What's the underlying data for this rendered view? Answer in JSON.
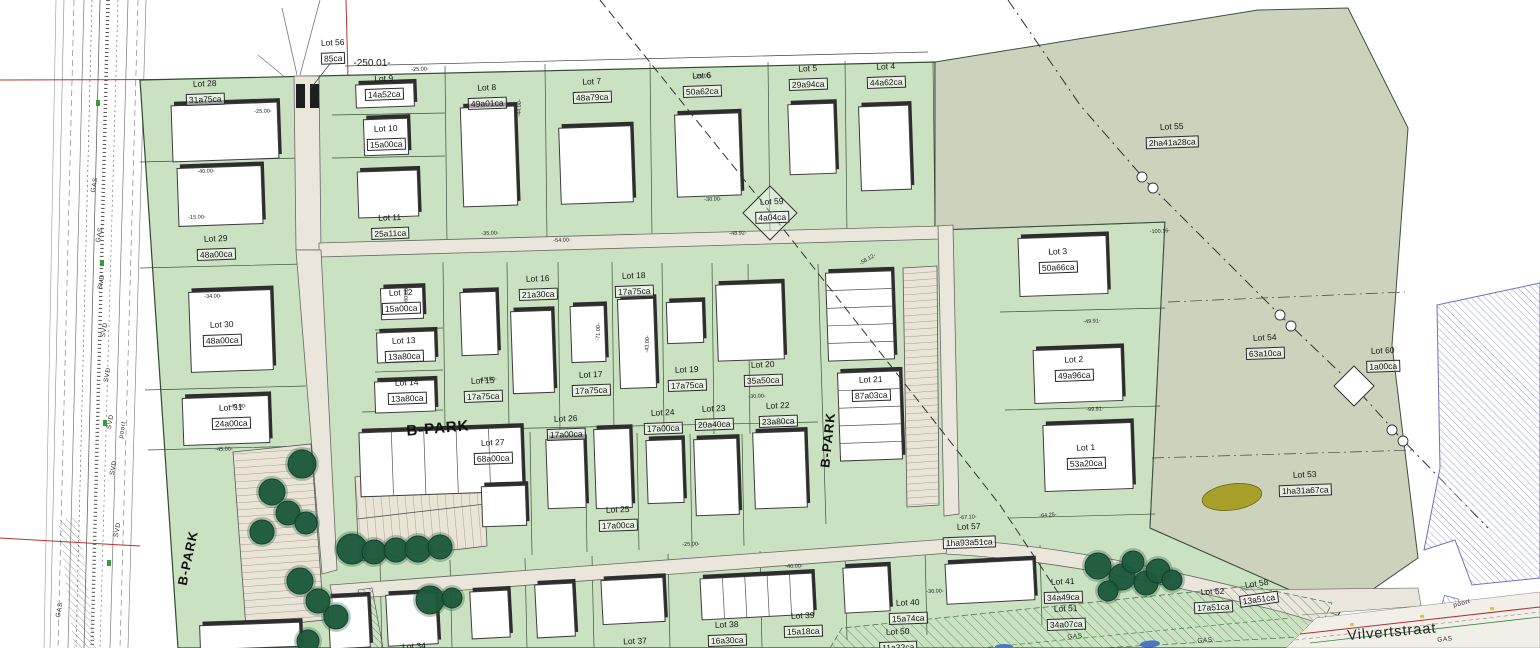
{
  "drawing": {
    "street_name": "Vilvertstraat",
    "park_label": "B-PARK",
    "overall_dimension": "-250.01-",
    "colors": {
      "parcel_green": "#cbe2c2",
      "reserve_olive": "#cdd2bd",
      "road_beige": "#eae6db",
      "building_fill": "#ffffff",
      "building_shadow": "#2d2d2d",
      "tree_green": "#1d5a3c",
      "existing_building_hatch_blue": "#9a9ad2",
      "pond_olive": "#a7a02b",
      "marker_red": "#c03030"
    }
  },
  "lots": [
    {
      "name": "Lot 28",
      "area": "31a75ca",
      "x": 205,
      "y": 93,
      "r": -2
    },
    {
      "name": "Lot 56",
      "area": "85ca",
      "x": 333,
      "y": 52,
      "r": -2
    },
    {
      "name": "Lot 9",
      "area": "14a52ca",
      "x": 384,
      "y": 88,
      "r": -2
    },
    {
      "name": "Lot 10",
      "area": "15a00ca",
      "x": 386,
      "y": 138,
      "r": -2
    },
    {
      "name": "Lot 11",
      "area": "25a11ca",
      "x": 390,
      "y": 227,
      "r": -2
    },
    {
      "name": "Lot 8",
      "area": "49a01ca",
      "x": 487,
      "y": 97,
      "r": -2
    },
    {
      "name": "Lot 7",
      "area": "48a79ca",
      "x": 592,
      "y": 91,
      "r": -2
    },
    {
      "name": "Lot 6",
      "area": "50a62ca",
      "x": 702,
      "y": 85,
      "r": -2
    },
    {
      "name": "Lot 5",
      "area": "29a94ca",
      "x": 808,
      "y": 78,
      "r": -2
    },
    {
      "name": "Lot 4",
      "area": "44a62ca",
      "x": 886,
      "y": 76,
      "r": -2
    },
    {
      "name": "Lot 55",
      "area": "2ha41a28ca",
      "x": 1172,
      "y": 136,
      "r": -2
    },
    {
      "name": "Lot 59",
      "area": "4a04ca",
      "x": 772,
      "y": 211,
      "r": -2
    },
    {
      "name": "Lot 29",
      "area": "48a00ca",
      "x": 216,
      "y": 248,
      "r": -2
    },
    {
      "name": "Lot 30",
      "area": "48a00ca",
      "x": 222,
      "y": 334,
      "r": -2
    },
    {
      "name": "Lot 31",
      "area": "24a00ca",
      "x": 231,
      "y": 417,
      "r": -2
    },
    {
      "name": "Lot 12",
      "area": "15a00ca",
      "x": 401,
      "y": 302,
      "r": -2
    },
    {
      "name": "Lot 13",
      "area": "13a80ca",
      "x": 404,
      "y": 350,
      "r": -2
    },
    {
      "name": "Lot 14",
      "area": "13a80ca",
      "x": 407,
      "y": 392,
      "r": -2
    },
    {
      "name": "Lot 15",
      "area": "17a75ca",
      "x": 483,
      "y": 390,
      "r": -2
    },
    {
      "name": "Lot 16",
      "area": "21a30ca",
      "x": 538,
      "y": 288,
      "r": -2
    },
    {
      "name": "Lot 17",
      "area": "17a75ca",
      "x": 591,
      "y": 384,
      "r": -2
    },
    {
      "name": "Lot 18",
      "area": "17a75ca",
      "x": 634,
      "y": 285,
      "r": -2
    },
    {
      "name": "Lot 19",
      "area": "17a75ca",
      "x": 687,
      "y": 379,
      "r": -2
    },
    {
      "name": "Lot 20",
      "area": "35a50ca",
      "x": 763,
      "y": 374,
      "r": -2
    },
    {
      "name": "Lot 21",
      "area": "87a03ca",
      "x": 871,
      "y": 389,
      "r": -2
    },
    {
      "name": "Lot 22",
      "area": "23a80ca",
      "x": 778,
      "y": 415,
      "r": -2
    },
    {
      "name": "Lot 23",
      "area": "20a40ca",
      "x": 714,
      "y": 418,
      "r": -2
    },
    {
      "name": "Lot 24",
      "area": "17a00ca",
      "x": 663,
      "y": 422,
      "r": -2
    },
    {
      "name": "Lot 25",
      "area": "17a00ca",
      "x": 618,
      "y": 519,
      "r": -2
    },
    {
      "name": "Lot 26",
      "area": "17a00ca",
      "x": 566,
      "y": 428,
      "r": -2
    },
    {
      "name": "Lot 27",
      "area": "68a00ca",
      "x": 493,
      "y": 452,
      "r": -2
    },
    {
      "name": "Lot 3",
      "area": "50a66ca",
      "x": 1058,
      "y": 261,
      "r": -2
    },
    {
      "name": "Lot 2",
      "area": "49a96ca",
      "x": 1074,
      "y": 369,
      "r": -2
    },
    {
      "name": "Lot 1",
      "area": "53a20ca",
      "x": 1086,
      "y": 457,
      "r": -2
    },
    {
      "name": "Lot 54",
      "area": "63a10ca",
      "x": 1265,
      "y": 347,
      "r": -2
    },
    {
      "name": "Lot 60",
      "area": "1a00ca",
      "x": 1383,
      "y": 360,
      "r": -2
    },
    {
      "name": "Lot 53",
      "area": "1ha31a67ca",
      "x": 1305,
      "y": 484,
      "r": -2
    },
    {
      "name": "Lot 57",
      "area": "1ha93a51ca",
      "x": 969,
      "y": 536,
      "r": -2
    },
    {
      "name": "Lot 34",
      "area": "",
      "x": 414,
      "y": 646,
      "r": -2
    },
    {
      "name": "Lot 37",
      "area": "",
      "x": 635,
      "y": 641,
      "r": -2
    },
    {
      "name": "Lot 38",
      "area": "16a30ca",
      "x": 727,
      "y": 634,
      "r": -2
    },
    {
      "name": "Lot 39",
      "area": "15a18ca",
      "x": 803,
      "y": 625,
      "r": -2
    },
    {
      "name": "Lot 40",
      "area": "15a74ca",
      "x": 908,
      "y": 612,
      "r": -2
    },
    {
      "name": "Lot 41",
      "area": "34a49ca",
      "x": 1063,
      "y": 591,
      "r": -2
    },
    {
      "name": "Lot 50",
      "area": "11a32ca",
      "x": 898,
      "y": 641,
      "r": -2
    },
    {
      "name": "Lot 51",
      "area": "34a07ca",
      "x": 1066,
      "y": 618,
      "r": -2
    },
    {
      "name": "Lot 52",
      "area": "17a51ca",
      "x": 1213,
      "y": 601,
      "r": -3
    },
    {
      "name": "Lot 58",
      "area": "13a51ca",
      "x": 1258,
      "y": 593,
      "r": -8
    }
  ],
  "corridor_labels": [
    {
      "text": "GAS",
      "x": 95,
      "y": 185,
      "r": -80
    },
    {
      "text": "GAS",
      "x": 100,
      "y": 235,
      "r": -80
    },
    {
      "text": "SVD",
      "x": 102,
      "y": 282,
      "r": -80
    },
    {
      "text": "SVD",
      "x": 105,
      "y": 330,
      "r": -80
    },
    {
      "text": "SVD",
      "x": 108,
      "y": 375,
      "r": -80
    },
    {
      "text": "SVD",
      "x": 111,
      "y": 422,
      "r": -80
    },
    {
      "text": "poort",
      "x": 123,
      "y": 430,
      "r": -80
    },
    {
      "text": "SVD",
      "x": 114,
      "y": 468,
      "r": -80
    },
    {
      "text": "SVD",
      "x": 118,
      "y": 530,
      "r": -80
    },
    {
      "text": "GAS",
      "x": 60,
      "y": 610,
      "r": -80
    }
  ],
  "street_labels": [
    {
      "text": "GAS",
      "x": 1075,
      "y": 637,
      "r": -4
    },
    {
      "text": "GAS",
      "x": 1205,
      "y": 641,
      "r": -4
    },
    {
      "text": "GAS",
      "x": 1445,
      "y": 640,
      "r": -6
    },
    {
      "text": "poort",
      "x": 1462,
      "y": 604,
      "r": -15
    }
  ],
  "dim_labels": [
    {
      "text": "-25.00-",
      "x": 263,
      "y": 112,
      "r": -2
    },
    {
      "text": "-40.00-",
      "x": 206,
      "y": 172,
      "r": -2
    },
    {
      "text": "-15.00-",
      "x": 197,
      "y": 218,
      "r": -2
    },
    {
      "text": "-34.00-",
      "x": 213,
      "y": 297,
      "r": -2
    },
    {
      "text": "-40.00-",
      "x": 238,
      "y": 407,
      "r": -2
    },
    {
      "text": "-45.00-",
      "x": 224,
      "y": 450,
      "r": -2
    },
    {
      "text": "-25.00-",
      "x": 420,
      "y": 70,
      "r": -2
    },
    {
      "text": "-25.00-",
      "x": 703,
      "y": 77,
      "r": -2
    },
    {
      "text": "-30.00-",
      "x": 713,
      "y": 200,
      "r": -2
    },
    {
      "text": "-35.00-",
      "x": 490,
      "y": 234,
      "r": -2
    },
    {
      "text": "-54.00-",
      "x": 562,
      "y": 241,
      "r": -2
    },
    {
      "text": "-48.92-",
      "x": 738,
      "y": 234,
      "r": -2
    },
    {
      "text": "-44.00-",
      "x": 520,
      "y": 108,
      "r": -88
    },
    {
      "text": "-58.12-",
      "x": 868,
      "y": 260,
      "r": -30
    },
    {
      "text": "-60.00-",
      "x": 407,
      "y": 295,
      "r": -88
    },
    {
      "text": "-71.00-",
      "x": 599,
      "y": 332,
      "r": -88
    },
    {
      "text": "-43.00-",
      "x": 648,
      "y": 344,
      "r": -88
    },
    {
      "text": "-15.00-",
      "x": 488,
      "y": 380,
      "r": -2
    },
    {
      "text": "-30.00-",
      "x": 757,
      "y": 397,
      "r": -2
    },
    {
      "text": "-40.00-",
      "x": 794,
      "y": 567,
      "r": -2
    },
    {
      "text": "-25.00-",
      "x": 691,
      "y": 545,
      "r": -2
    },
    {
      "text": "-30.00-",
      "x": 935,
      "y": 592,
      "r": -2
    },
    {
      "text": "-67.10-",
      "x": 968,
      "y": 518,
      "r": -3
    },
    {
      "text": "-64.25-",
      "x": 1048,
      "y": 516,
      "r": -5
    },
    {
      "text": "-100.16-",
      "x": 1160,
      "y": 232,
      "r": -3
    },
    {
      "text": "-49.91-",
      "x": 1092,
      "y": 322,
      "r": -3
    },
    {
      "text": "-99.91-",
      "x": 1095,
      "y": 410,
      "r": -3
    }
  ]
}
